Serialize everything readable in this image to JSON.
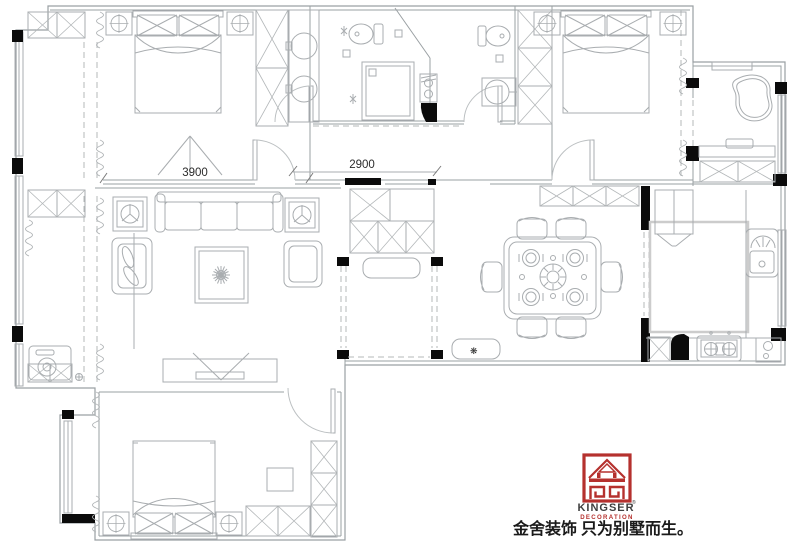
{
  "drawing": {
    "type": "apartment-floor-plan",
    "dimensions": {
      "bedroom_top_left_width": "3900",
      "hall_width": "2900"
    },
    "entry": {
      "bench_glyph": "❋"
    },
    "logo": {
      "brand": "KINGSER",
      "registered": "®",
      "subtitle": "DECORATION",
      "slogan": "金舍装饰 只为别墅而生。",
      "brand_color": "#b5312e",
      "text_color": "#3f3f3f"
    },
    "colors": {
      "background": "#ffffff",
      "wall_line": "#9aa0a3",
      "furniture_line": "#a9adb0",
      "column_fill": "#0b0b0b",
      "dimension_text": "#2b2b2b"
    }
  }
}
